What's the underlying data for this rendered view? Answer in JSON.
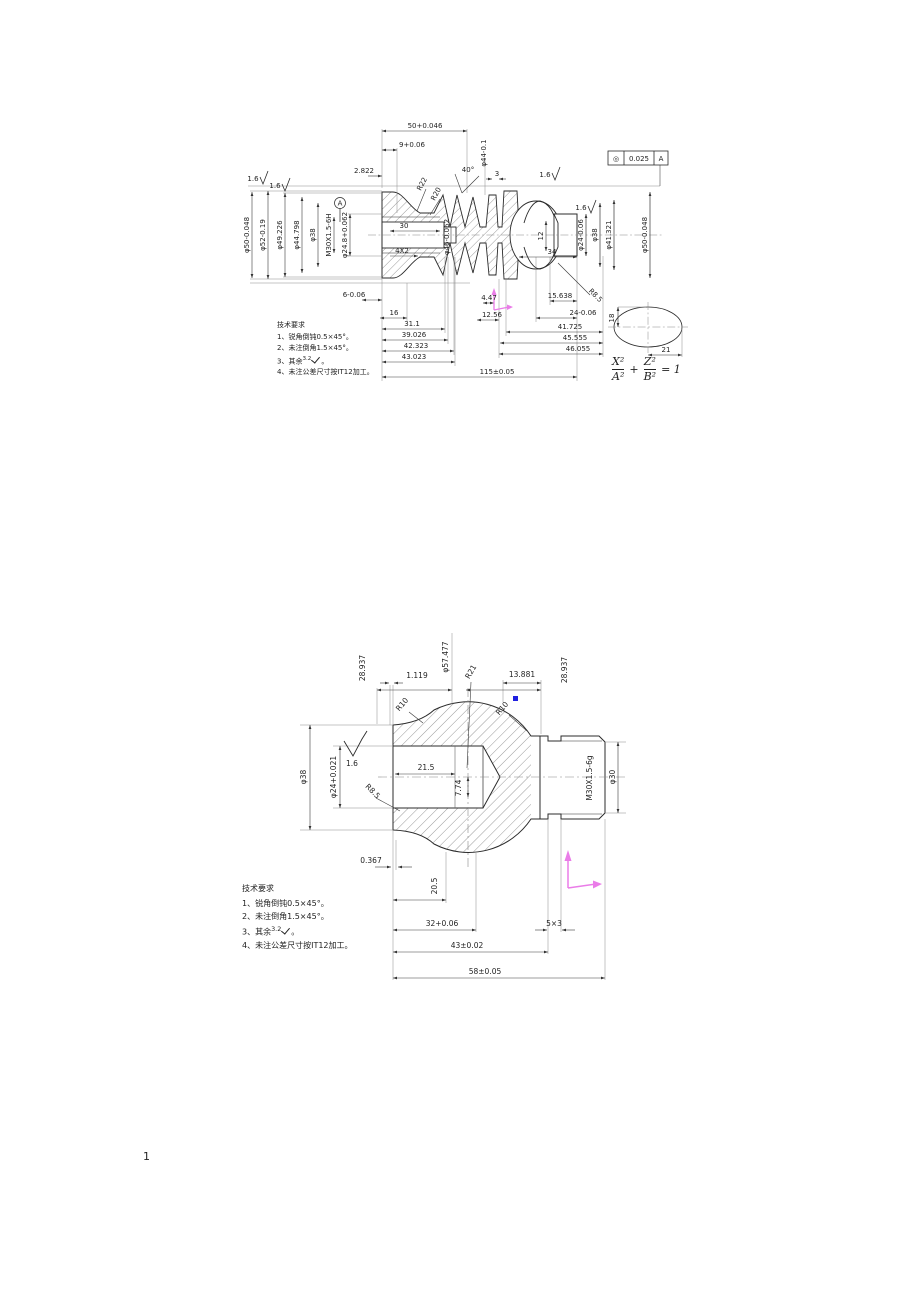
{
  "page": {
    "number": "1"
  },
  "top": {
    "dims": {
      "len50": "50+0.046",
      "len9": "9+0.06",
      "len2822": "2.822",
      "dia44": "φ44-0.1",
      "thk3": "3",
      "ang40": "40°",
      "r22": "R22",
      "r20": "R20",
      "datum": "A",
      "gdt_symbol": "◎",
      "gdt_value": "0.025",
      "gdt_datum": "A",
      "rough1": "1.6",
      "rough2": "1.6",
      "rough3": "1.6",
      "rough4": "1.6",
      "dia50L": "φ50-0.048",
      "dia52": "φ52-0.19",
      "dia49226": "φ49.226",
      "dia44798": "φ44.798",
      "dia38L": "φ38",
      "threadL": "M30X1.5-6H",
      "dia248": "φ24.8+0.062",
      "len30": "30",
      "groove4x2": "4X2",
      "dia46": "φ46-0.062",
      "len12": "12",
      "len34": "34",
      "dia24R": "φ24-0.06",
      "dia38R": "φ38",
      "dia41321": "φ41.321",
      "dia50R": "φ50-0.048",
      "len6": "6-0.06",
      "len16": "16",
      "len447": "4.47",
      "len1256": "12.56",
      "len15638": "15.638",
      "len24": "24-0.06",
      "len311": "31.1",
      "len39026": "39.026",
      "len42323": "42.323",
      "len43023": "43.023",
      "len41725": "41.725",
      "len45555": "45.555",
      "len46055": "46.055",
      "len115": "115±0.05",
      "r85": "R8.5",
      "ell18": "18",
      "ell21": "21"
    },
    "formula": {
      "xn": "X²",
      "xd": "A²",
      "plus": "+",
      "zn": "Z²",
      "zd": "B²",
      "eq": "= 1"
    },
    "notes": {
      "title": "技术要求",
      "line1": "1、锐角倒钝0.5×45°。",
      "line2": "2、未注倒角1.5×45°。",
      "line3_prefix": "3、其余",
      "rough": "3.2",
      "line3_suffix": "。",
      "line4": "4、未注公差尺寸按IT12加工。"
    }
  },
  "bottom": {
    "dims": {
      "dia57477": "φ57.477",
      "len28937L": "28.937",
      "len1119": "1.119",
      "r21": "R21",
      "len13881": "13.881",
      "len28937R": "28.937",
      "r10L": "R10",
      "r10R": "R10",
      "dia38": "φ38",
      "rough": "1.6",
      "dia24": "φ24+0.021",
      "len215": "21.5",
      "len774": "7.74",
      "r85": "R8.5",
      "thread": "M30X1.5-6g",
      "dia30": "φ30",
      "len0367": "0.367",
      "len205": "20.5",
      "len32": "32+0.06",
      "groove5x3": "5×3",
      "len43": "43±0.02",
      "len58": "58±0.05"
    },
    "notes": {
      "title": "技术要求",
      "line1": "1、锐角倒钝0.5×45°。",
      "line2": "2、未注倒角1.5×45°。",
      "line3_prefix": "3、其余",
      "rough": "3.2",
      "line3_suffix": "。",
      "line4": "4、未注公差尺寸按IT12加工。"
    }
  }
}
